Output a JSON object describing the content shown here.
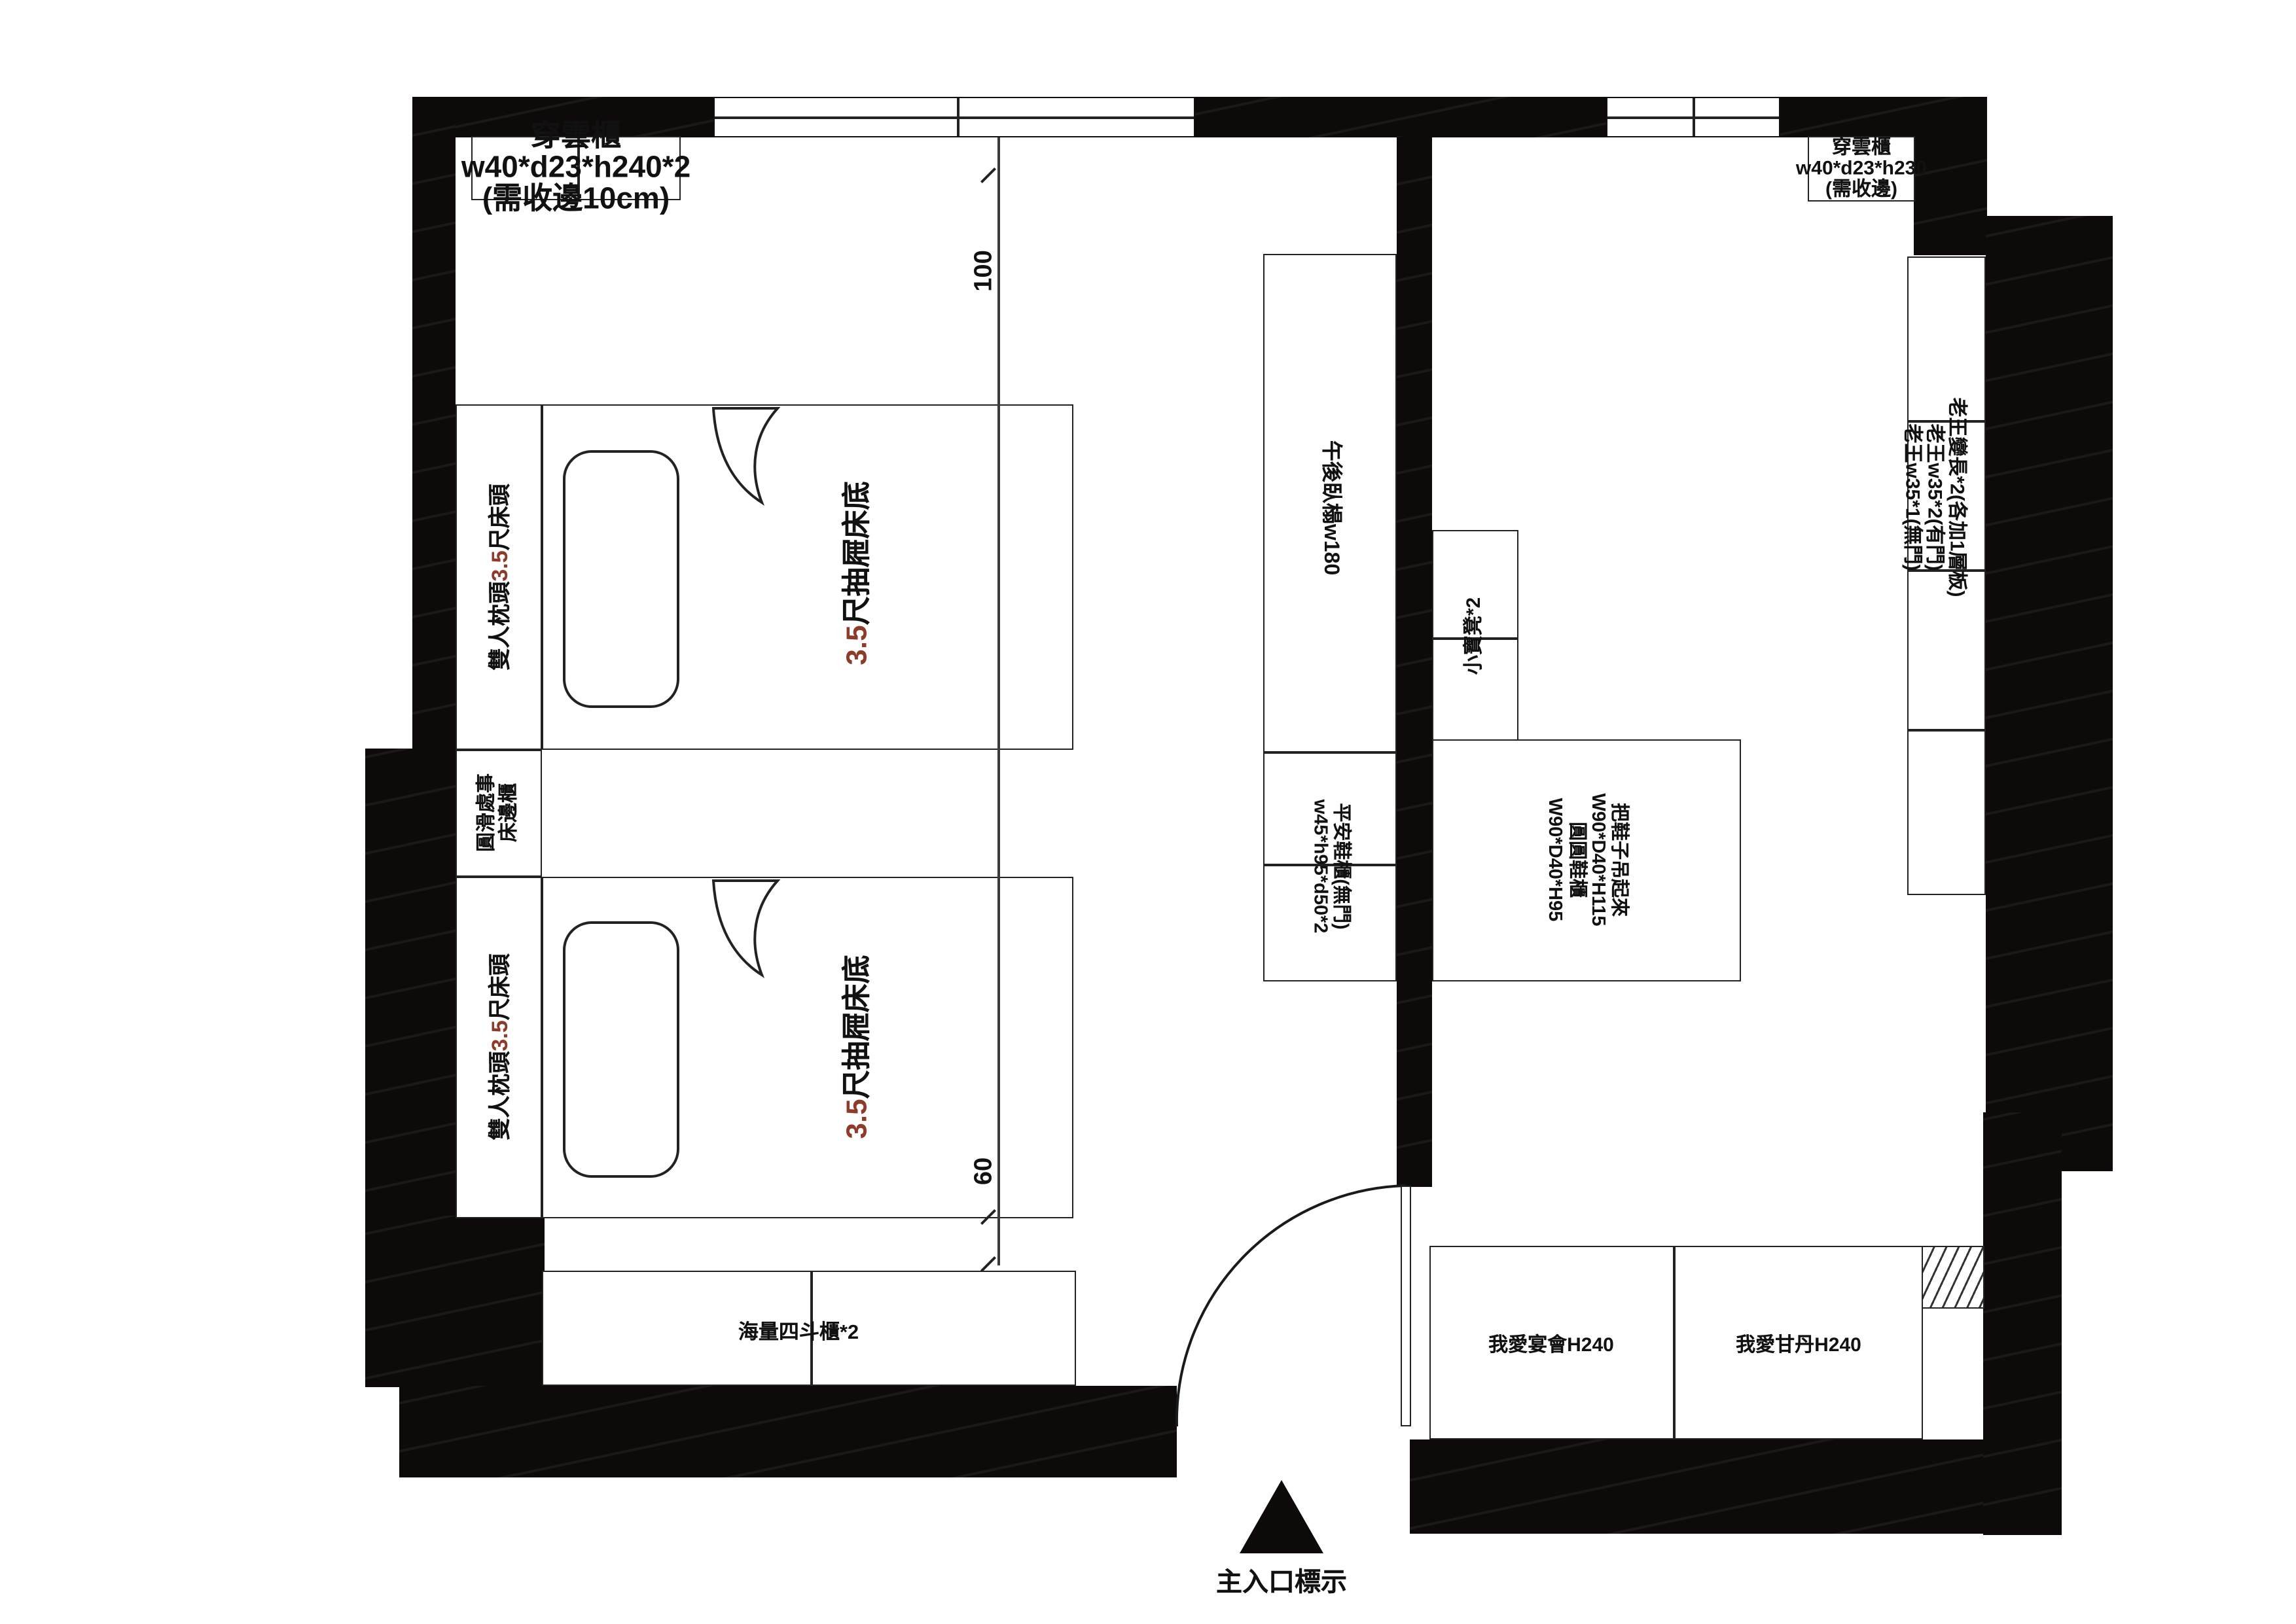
{
  "colors": {
    "wall": "#0d0a09",
    "line": "#222222",
    "accent_red": "#8e3b2a"
  },
  "furniture": {
    "closet_top_left": {
      "line1": "穿雲櫃",
      "line2": "w40*d23*h240*2",
      "line3": "(需收邊10cm)"
    },
    "closet_top_right": {
      "line1": "穿雲櫃",
      "line2": "w40*d23*h230",
      "line3": "(需收邊)"
    },
    "bed_head_upper": {
      "part1": "雙人枕頭",
      "part2": "3.5",
      "part3": "尺床頭"
    },
    "bed_head_lower": {
      "part1": "雙人枕頭",
      "part2": "3.5",
      "part3": "尺床頭"
    },
    "bed_upper": {
      "part1": "3.5",
      "part2": "尺抽屜床底"
    },
    "bed_lower": {
      "part1": "3.5",
      "part2": "尺抽屜床底"
    },
    "bedside_cabinet": {
      "line1": "圓滑處事",
      "line2": "床邊櫃"
    },
    "daybed": {
      "label": "午後臥榻w180"
    },
    "stools": {
      "label": "小寶凳*2"
    },
    "shoe_cabinet_left": {
      "line1": "平安鞋櫃(無門)",
      "line2": "w45*h95*d50*2"
    },
    "shoe_cabinet_right": {
      "line1": "把鞋子吊起來",
      "line2": "W90*D40*H115",
      "line3": "圓圓鞋櫃",
      "line4": "W90*D40*H95"
    },
    "tall_wardrobe": {
      "line1": "老王變長*2(各加1層板)",
      "line2": "老王w35*2(有門)",
      "line3": "老王w35*1(無門)"
    },
    "dresser": {
      "label": "海量四斗櫃*2"
    },
    "cabinet_banquet": {
      "label": "我愛宴會H240"
    },
    "cabinet_gandan": {
      "label": "我愛甘丹H240"
    }
  },
  "dimensions": {
    "top": "100",
    "bottom": "60"
  },
  "entrance": {
    "label": "主入口標示"
  }
}
